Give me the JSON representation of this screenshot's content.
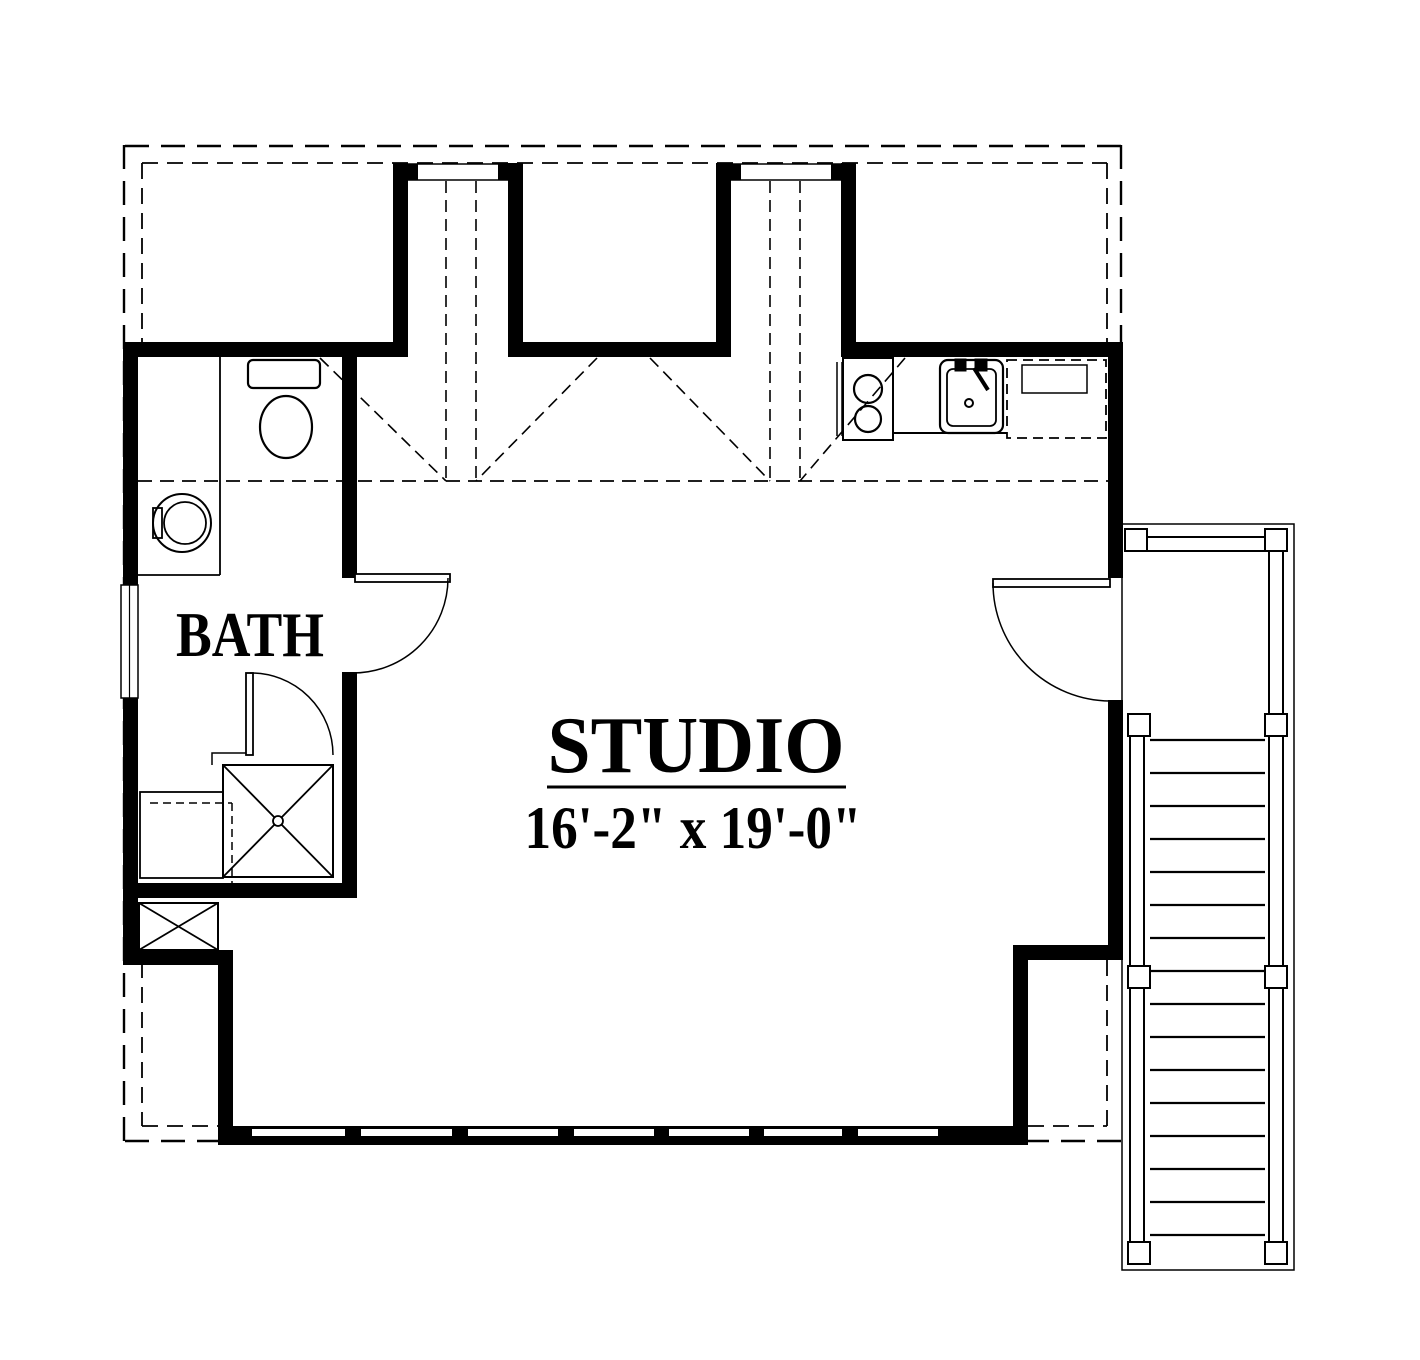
{
  "rooms": {
    "bath": {
      "label": "BATH"
    },
    "studio": {
      "label": "STUDIO",
      "dimensions": "16'-2\" x 19'-0\""
    }
  },
  "fixtures": {
    "bath": [
      "toilet",
      "washing-machine",
      "shower",
      "linen-cabinet",
      "chase"
    ],
    "kitchen": [
      "cooktop",
      "kitchen-sink",
      "dishwasher"
    ],
    "exterior": [
      "landing",
      "stair-run",
      "guard-rail-posts"
    ],
    "doors": [
      "bath-door",
      "shower-door",
      "entry-door"
    ],
    "lines": [
      "roof-overhang-dashed",
      "ceiling-break-dashed",
      "dormer-cheek-dashed"
    ]
  },
  "colors": {
    "line": "#000000",
    "background": "#ffffff"
  }
}
